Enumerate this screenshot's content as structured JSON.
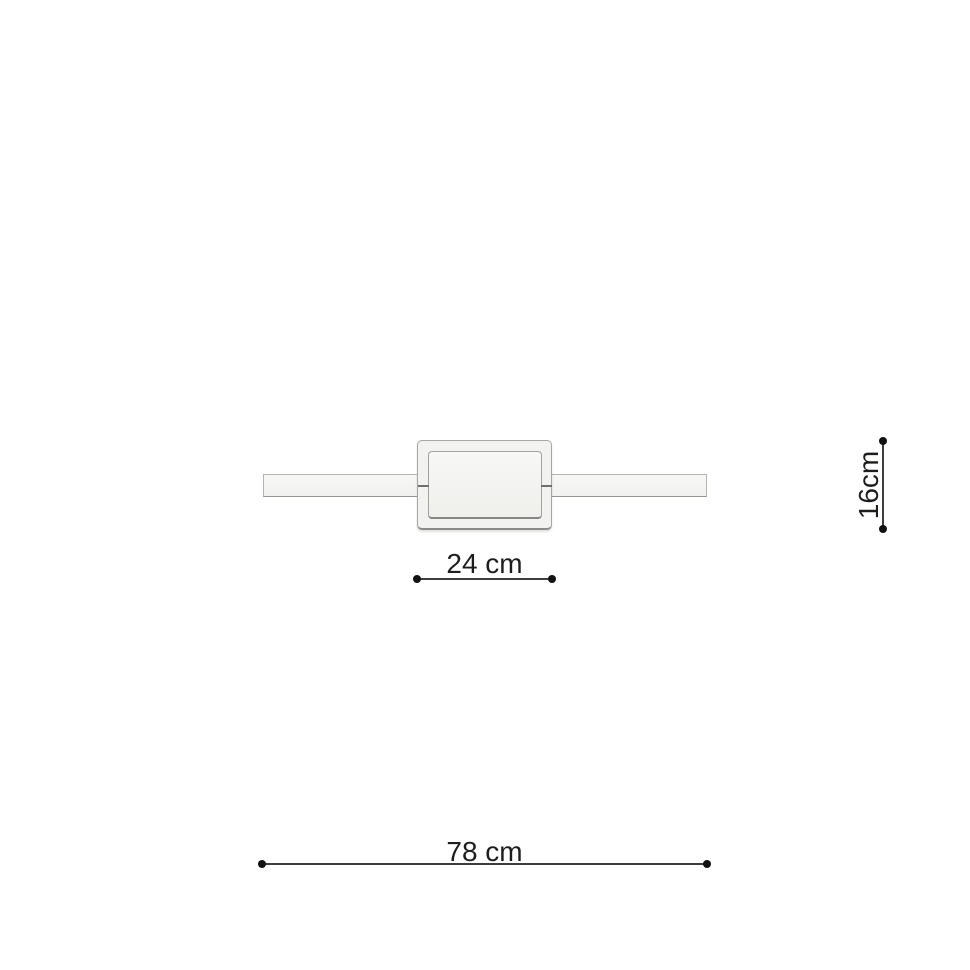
{
  "page": {
    "background_color": "#ffffff"
  },
  "diagram": {
    "colors": {
      "fixture_fill": "#f2f2f0",
      "fixture_outline": "#a6a6a3",
      "fixture_shadow_edge": "#8b8b88",
      "seam_line": "#6f6f6c",
      "dimension_line": "#3d3d3d",
      "dimension_dot": "#121212",
      "label_text": "#1d1d1b"
    },
    "dimensions": {
      "width": {
        "label": "24 cm",
        "value_cm": 24
      },
      "height": {
        "label": "16cm",
        "value_cm": 16
      },
      "length": {
        "label": "78 cm",
        "value_cm": 78
      }
    }
  }
}
